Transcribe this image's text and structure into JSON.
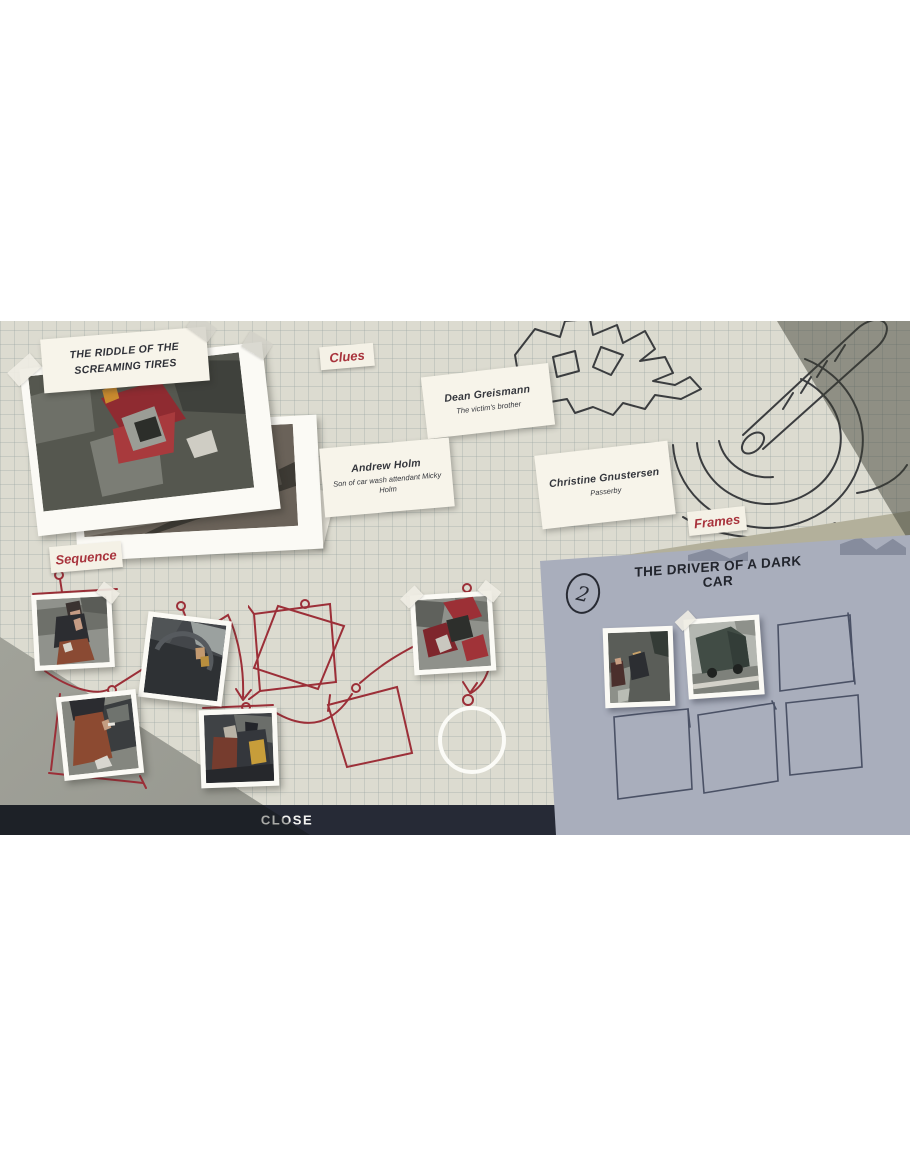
{
  "case_board": {
    "title": "THE RIDDLE OF THE SCREAMING TIRES",
    "section_labels": {
      "clues": "Clues",
      "sequence": "Sequence",
      "frames": "Frames"
    }
  },
  "clue_cards": [
    {
      "name": "Dean Greismann",
      "description": "The victim's brother"
    },
    {
      "name": "Andrew Holm",
      "description": "Son of car wash attendant Micky Holm"
    },
    {
      "name": "Christine Gnustersen",
      "description": "Passerby"
    }
  ],
  "frames_panel": {
    "number": "2",
    "title": "THE DRIVER OF A DARK CAR"
  },
  "footer": {
    "close_label": "CLOSE"
  },
  "colors": {
    "paper": "#dcdbd0",
    "accent_red": "#9c2f38",
    "panel_blue_grey": "#a9aebc",
    "slot_outline": "#4a5165",
    "footer_bar": "#262a36",
    "ink": "#2b2d34"
  }
}
